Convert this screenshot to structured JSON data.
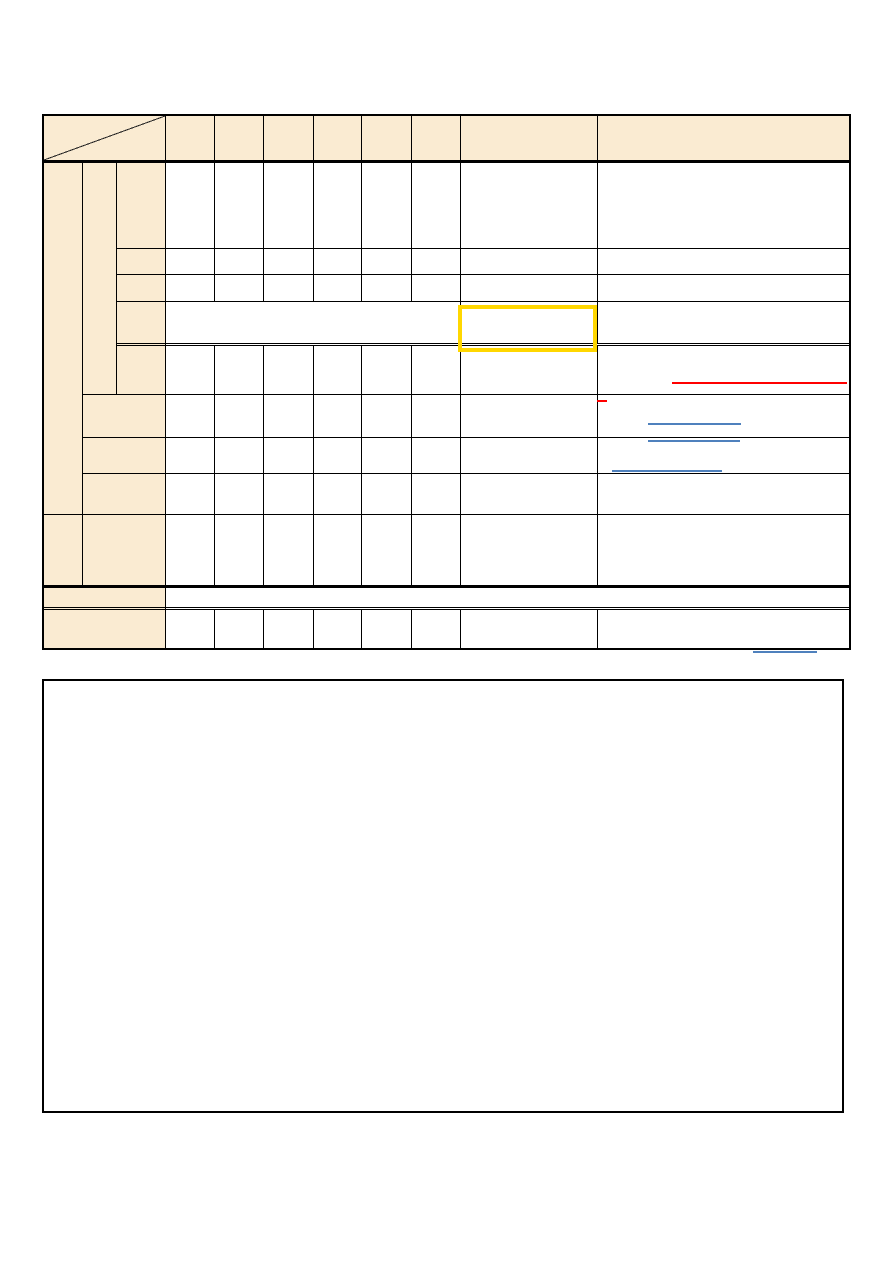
{
  "page": {
    "background": "#ffffff",
    "width": 893,
    "height": 1262
  },
  "colors": {
    "cell_fill": "#FAEBD2",
    "grid_line": "#000000",
    "highlight_box": "#FFD700",
    "red_line": "#FF0000",
    "blue_line": "#4F81BD"
  },
  "annotations": {
    "yellow_highlight_box": {
      "x": 458,
      "y": 305,
      "width": 139,
      "height": 47
    },
    "red_underlines": [
      {
        "x": 672,
        "y": 382,
        "width": 175
      },
      {
        "x": 597,
        "y": 400,
        "width": 10
      }
    ],
    "blue_underlines": [
      {
        "x": 648,
        "y": 423,
        "width": 93
      },
      {
        "x": 648,
        "y": 440,
        "width": 92
      },
      {
        "x": 612,
        "y": 470,
        "width": 110
      },
      {
        "x": 753,
        "y": 651,
        "width": 64
      }
    ]
  }
}
